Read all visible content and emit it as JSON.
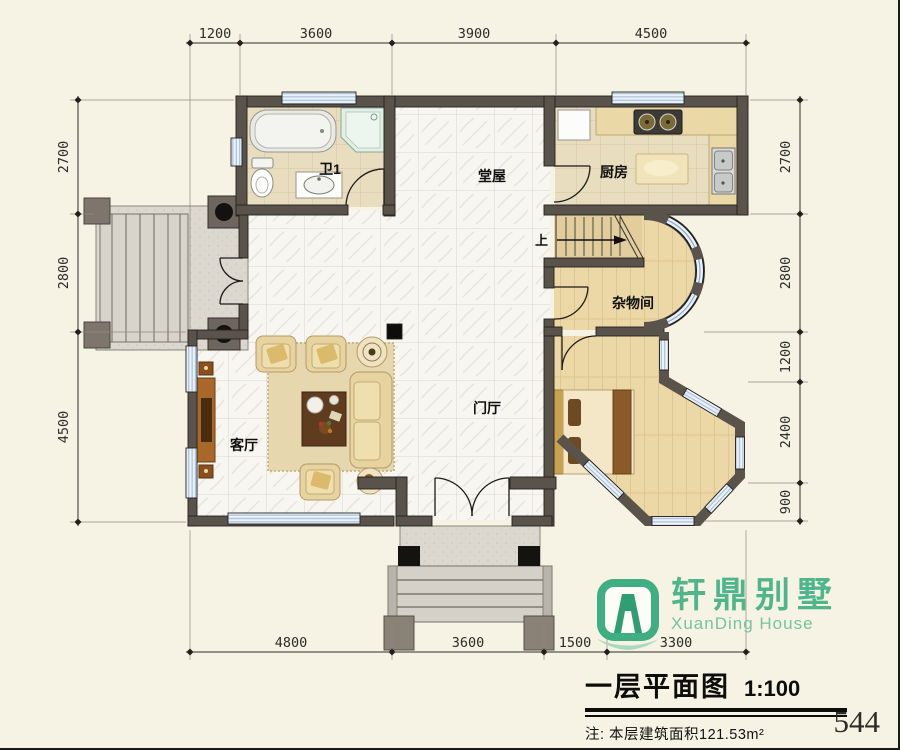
{
  "page": {
    "number": "544"
  },
  "title_block": {
    "title": "一层平面图",
    "scale": "1:100",
    "note": "注: 本层建筑面积121.53m²"
  },
  "logo": {
    "cn": "轩鼎别墅",
    "en": "XuanDing House"
  },
  "rooms": {
    "bathroom": "卫1",
    "hall": "堂屋",
    "kitchen": "厨房",
    "storage": "杂物间",
    "living": "客厅",
    "foyer": "门厅"
  },
  "stairs": {
    "up": "上"
  },
  "dims": {
    "top": [
      "1200",
      "3600",
      "3900",
      "4500"
    ],
    "bottom": [
      "4800",
      "3600",
      "1500",
      "3300"
    ],
    "left": [
      "2700",
      "2800",
      "4500"
    ],
    "right": [
      "2700",
      "2800",
      "1200",
      "2400",
      "900"
    ]
  },
  "colors": {
    "logo_green": "#4fb68c",
    "wall": "#5a534b",
    "window_blue": "#a8c0d8",
    "wood_floor": "#ecd7a7",
    "tan_tile": "#e9ddc0"
  }
}
